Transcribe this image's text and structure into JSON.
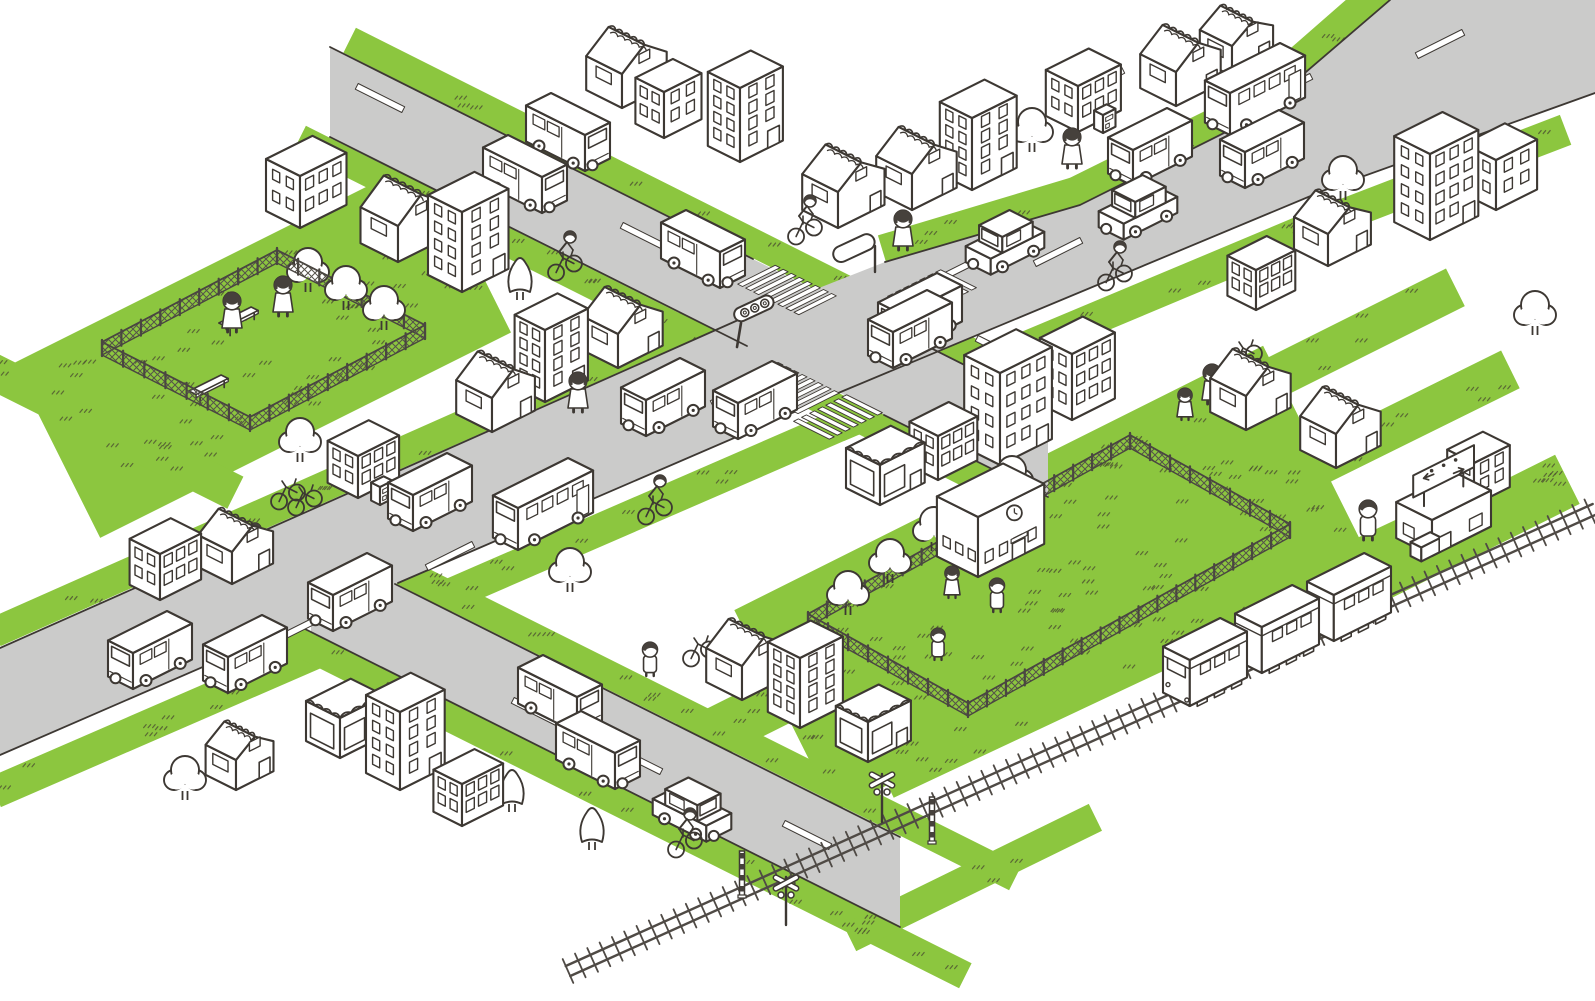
{
  "title": "isometric-town-map-illustration",
  "colors": {
    "outline": "#3d3833",
    "road": "#cbcbca",
    "grass": "#8cc63f",
    "tuft": "#4e5132",
    "white": "#ffffff",
    "mesh": "#55524a",
    "rail": "#4f4a45"
  },
  "roads": {
    "fills": [
      {
        "name": "avenue-ne-sw",
        "pts": [
          [
            0,
            648
          ],
          [
            745,
            317
          ],
          [
            885,
            262
          ],
          [
            1080,
            205
          ],
          [
            1250,
            120
          ],
          [
            1390,
            0
          ],
          [
            1595,
            0
          ],
          [
            1595,
            93
          ],
          [
            1325,
            190
          ],
          [
            843,
            391
          ],
          [
            398,
            583
          ],
          [
            258,
            643
          ],
          [
            0,
            755
          ]
        ]
      },
      {
        "name": "road-nw",
        "pts": [
          [
            330,
            47
          ],
          [
            1048,
            407
          ],
          [
            1048,
            497
          ],
          [
            330,
            137
          ]
        ]
      },
      {
        "name": "road-crossing-branch",
        "pts": [
          [
            311,
            542
          ],
          [
            900,
            836
          ],
          [
            900,
            926
          ],
          [
            311,
            632
          ]
        ]
      }
    ],
    "edges": [
      [
        [
          0,
          648
        ],
        [
          745,
          317
        ]
      ],
      [
        [
          885,
          262
        ],
        [
          1080,
          205
        ],
        [
          1250,
          120
        ],
        [
          1390,
          0
        ]
      ],
      [
        [
          0,
          755
        ],
        [
          258,
          643
        ]
      ],
      [
        [
          398,
          583
        ],
        [
          843,
          391
        ],
        [
          1325,
          190
        ],
        [
          1595,
          93
        ]
      ],
      [
        [
          330,
          47
        ],
        [
          753,
          259
        ]
      ],
      [
        [
          887,
          326
        ],
        [
          1048,
          407
        ]
      ],
      [
        [
          330,
          137
        ],
        [
          747,
          346
        ]
      ],
      [
        [
          884,
          415
        ],
        [
          1048,
          497
        ]
      ],
      [
        [
          395,
          584
        ],
        [
          900,
          837
        ]
      ],
      [
        [
          299,
          626
        ],
        [
          900,
          927
        ]
      ]
    ],
    "dashes_ne": [
      [
        300,
        628
      ],
      [
        450,
        556
      ],
      [
        735,
        392
      ],
      [
        965,
        266
      ],
      [
        1058,
        252
      ],
      [
        1100,
        82
      ],
      [
        1288,
        88
      ],
      [
        1440,
        44
      ]
    ],
    "dashes_se": [
      [
        380,
        98
      ],
      [
        645,
        237
      ],
      [
        1000,
        350
      ],
      [
        536,
        712
      ],
      [
        638,
        760
      ],
      [
        807,
        835
      ]
    ]
  },
  "intersection": {
    "x": 815,
    "y": 335,
    "crosswalks": [
      {
        "c": [
          787,
          290
        ],
        "stripe_axis": "ne",
        "repeat_axis": "se",
        "n": 8,
        "step": 9,
        "len": 42
      },
      {
        "c": [
          932,
          292
        ],
        "stripe_axis": "se",
        "repeat_axis": "ne",
        "n": 7,
        "step": 9,
        "len": 40
      },
      {
        "c": [
          788,
          388
        ],
        "stripe_axis": "ne",
        "repeat_axis": "se",
        "n": 8,
        "step": 9,
        "len": 46
      },
      {
        "c": [
          838,
          417
        ],
        "stripe_axis": "se",
        "repeat_axis": "ne",
        "n": 7,
        "step": 9,
        "len": 40
      }
    ]
  },
  "railway": {
    "x1": 568,
    "y1": 971,
    "x2": 1595,
    "y2": 509,
    "tie_step": 13.5,
    "tie_half": 13,
    "gauge_half": 5.5
  },
  "crossing_signals": [
    {
      "type": "stripe-pole",
      "x": 742,
      "y": 897
    },
    {
      "type": "crossbuck",
      "x": 786,
      "y": 925
    },
    {
      "type": "crossbuck",
      "x": 882,
      "y": 822
    },
    {
      "type": "stripe-pole",
      "x": 932,
      "y": 843
    }
  ],
  "greens": [
    {
      "pts": [
        [
          0,
          790
        ],
        [
          843,
          424
        ],
        [
          1325,
          222
        ],
        [
          1560,
          132
        ]
      ],
      "w": 32
    },
    {
      "pts": [
        [
          0,
          630
        ],
        [
          745,
          300
        ]
      ],
      "w": 30
    },
    {
      "pts": [
        [
          888,
          248
        ],
        [
          1075,
          192
        ],
        [
          1245,
          108
        ],
        [
          1380,
          -10
        ]
      ],
      "w": 30
    },
    {
      "pts": [
        [
          305,
          141
        ],
        [
          1023,
          501
        ]
      ],
      "w": 28
    },
    {
      "pts": [
        [
          355,
          43
        ],
        [
          1073,
          403
        ]
      ],
      "w": 28
    },
    {
      "pts": [
        [
          286,
          636
        ],
        [
          960,
          973
        ]
      ],
      "w": 28
    },
    {
      "pts": [
        [
          336,
          538
        ],
        [
          1010,
          875
        ]
      ],
      "w": 28
    },
    {
      "pts": [
        [
          891,
          778
        ],
        [
          1440,
          520
        ]
      ],
      "w": 38
    },
    {
      "pts": [
        [
          855,
          935
        ],
        [
          1090,
          820
        ]
      ],
      "w": 30
    },
    {
      "pts": [
        [
          62,
          448
        ],
        [
          462,
          248
        ]
      ],
      "w": 195
    },
    {
      "pts": [
        [
          790,
          708
        ],
        [
          1308,
          449
        ]
      ],
      "w": 225
    },
    {
      "pts": [
        [
          1090,
          470
        ],
        [
          1450,
          290
        ]
      ],
      "w": 42
    },
    {
      "pts": [
        [
          1125,
          560
        ],
        [
          1505,
          372
        ]
      ],
      "w": 42
    },
    {
      "pts": [
        [
          1330,
          598
        ],
        [
          1562,
          482
        ]
      ],
      "w": 55
    },
    {
      "pts": [
        [
          640,
          770
        ],
        [
          950,
          615
        ]
      ],
      "w": 50
    },
    {
      "pts": [
        [
          -10,
          370
        ],
        [
          230,
          490
        ]
      ],
      "w": 36
    }
  ],
  "parks": [
    {
      "name": "pocket-park",
      "quad": [
        [
          277,
          263
        ],
        [
          425,
          338
        ],
        [
          250,
          430
        ],
        [
          102,
          355
        ]
      ]
    },
    {
      "name": "schoolyard",
      "quad": [
        [
          1130,
          448
        ],
        [
          1290,
          537
        ],
        [
          968,
          716
        ],
        [
          808,
          627
        ]
      ]
    }
  ],
  "benches": [
    [
      235,
      322
    ],
    [
      205,
      390
    ]
  ],
  "buildings": [
    {
      "t": "office",
      "x": 300,
      "y": 228,
      "w": 52,
      "d": 38,
      "h": 52,
      "f": 2,
      "c": 3
    },
    {
      "t": "house",
      "x": 398,
      "y": 262,
      "w": 52,
      "d": 42,
      "h": 36,
      "rh": 20
    },
    {
      "t": "office",
      "x": 462,
      "y": 292,
      "w": 52,
      "d": 38,
      "h": 80,
      "f": 4,
      "c": 2,
      "door": true
    },
    {
      "t": "house",
      "x": 622,
      "y": 108,
      "w": 50,
      "d": 40,
      "h": 34,
      "rh": 18
    },
    {
      "t": "office",
      "x": 664,
      "y": 138,
      "w": 42,
      "d": 32,
      "h": 46,
      "f": 2,
      "c": 2
    },
    {
      "t": "office",
      "x": 740,
      "y": 162,
      "w": 48,
      "d": 36,
      "h": 74,
      "f": 4,
      "c": 2,
      "door": true
    },
    {
      "t": "house",
      "x": 838,
      "y": 228,
      "w": 52,
      "d": 40,
      "h": 36,
      "rh": 18
    },
    {
      "t": "house",
      "x": 492,
      "y": 432,
      "w": 48,
      "d": 40,
      "h": 34,
      "rh": 18
    },
    {
      "t": "office",
      "x": 545,
      "y": 402,
      "w": 48,
      "d": 34,
      "h": 72,
      "f": 4,
      "c": 2,
      "door": true
    },
    {
      "t": "house",
      "x": 618,
      "y": 368,
      "w": 50,
      "d": 40,
      "h": 34,
      "rh": 18
    },
    {
      "t": "office",
      "x": 358,
      "y": 498,
      "w": 46,
      "d": 34,
      "h": 42,
      "f": 2,
      "c": 3
    },
    {
      "t": "office",
      "x": 160,
      "y": 600,
      "w": 46,
      "d": 34,
      "h": 46,
      "f": 2,
      "c": 3
    },
    {
      "t": "house",
      "x": 232,
      "y": 584,
      "w": 46,
      "d": 38,
      "h": 32,
      "rh": 16
    },
    {
      "t": "shop",
      "x": 340,
      "y": 758,
      "w": 50,
      "d": 38,
      "h": 40
    },
    {
      "t": "office",
      "x": 400,
      "y": 790,
      "w": 50,
      "d": 38,
      "h": 78,
      "f": 4,
      "c": 2,
      "door": true
    },
    {
      "t": "office",
      "x": 462,
      "y": 826,
      "w": 46,
      "d": 32,
      "h": 42,
      "f": 2,
      "c": 3
    },
    {
      "t": "house",
      "x": 236,
      "y": 790,
      "w": 42,
      "d": 34,
      "h": 30,
      "rh": 14
    },
    {
      "t": "house",
      "x": 742,
      "y": 700,
      "w": 50,
      "d": 40,
      "h": 34,
      "rh": 18
    },
    {
      "t": "office",
      "x": 800,
      "y": 728,
      "w": 48,
      "d": 36,
      "h": 70,
      "f": 4,
      "c": 2
    },
    {
      "t": "shop",
      "x": 868,
      "y": 762,
      "w": 48,
      "d": 36,
      "h": 40
    },
    {
      "t": "shop",
      "x": 880,
      "y": 505,
      "w": 50,
      "d": 38,
      "h": 40
    },
    {
      "t": "office",
      "x": 938,
      "y": 480,
      "w": 44,
      "d": 32,
      "h": 44,
      "f": 2,
      "c": 3
    },
    {
      "t": "office",
      "x": 1000,
      "y": 465,
      "w": 58,
      "d": 40,
      "h": 92,
      "f": 4,
      "c": 3,
      "door": true
    },
    {
      "t": "office",
      "x": 1072,
      "y": 420,
      "w": 48,
      "d": 36,
      "h": 66,
      "f": 3,
      "c": 3
    },
    {
      "t": "school",
      "x": 978,
      "y": 577,
      "w": 74,
      "d": 46,
      "h": 60
    },
    {
      "t": "house",
      "x": 912,
      "y": 210,
      "w": 50,
      "d": 40,
      "h": 36,
      "rh": 18
    },
    {
      "t": "office",
      "x": 972,
      "y": 190,
      "w": 50,
      "d": 36,
      "h": 72,
      "f": 4,
      "c": 2,
      "door": true
    },
    {
      "t": "office",
      "x": 1078,
      "y": 132,
      "w": 48,
      "d": 36,
      "h": 46,
      "f": 2,
      "c": 3
    },
    {
      "t": "house",
      "x": 1176,
      "y": 106,
      "w": 50,
      "d": 40,
      "h": 34,
      "rh": 18
    },
    {
      "t": "house",
      "x": 1232,
      "y": 76,
      "w": 46,
      "d": 36,
      "h": 30,
      "rh": 14
    },
    {
      "t": "office",
      "x": 1430,
      "y": 240,
      "w": 54,
      "d": 40,
      "h": 86,
      "f": 4,
      "c": 3,
      "door": true
    },
    {
      "t": "office",
      "x": 1496,
      "y": 210,
      "w": 46,
      "d": 36,
      "h": 50,
      "f": 2,
      "c": 2
    },
    {
      "t": "house",
      "x": 1328,
      "y": 266,
      "w": 48,
      "d": 38,
      "h": 32,
      "rh": 16
    },
    {
      "t": "office",
      "x": 1256,
      "y": 310,
      "w": 44,
      "d": 32,
      "h": 40,
      "f": 2,
      "c": 3
    },
    {
      "t": "house",
      "x": 1246,
      "y": 430,
      "w": 50,
      "d": 40,
      "h": 34,
      "rh": 18
    },
    {
      "t": "house",
      "x": 1336,
      "y": 468,
      "w": 50,
      "d": 40,
      "h": 34,
      "rh": 18
    },
    {
      "t": "office",
      "x": 1474,
      "y": 505,
      "w": 40,
      "d": 30,
      "h": 42,
      "f": 2,
      "c": 2
    },
    {
      "t": "station",
      "x": 1432,
      "y": 556,
      "w": 66,
      "d": 40,
      "h": 36
    }
  ],
  "vehicles": [
    {
      "t": "van",
      "x": 1150,
      "y": 165,
      "o": "sw"
    },
    {
      "t": "van",
      "x": 1262,
      "y": 167,
      "o": "ne"
    },
    {
      "t": "car",
      "x": 1138,
      "y": 220,
      "o": "sw"
    },
    {
      "t": "bus",
      "x": 1255,
      "y": 110,
      "o": "sw"
    },
    {
      "t": "car",
      "x": 1005,
      "y": 255,
      "o": "sw"
    },
    {
      "t": "van",
      "x": 920,
      "y": 330,
      "o": "ne"
    },
    {
      "t": "van",
      "x": 663,
      "y": 415,
      "o": "sw"
    },
    {
      "t": "van",
      "x": 755,
      "y": 418,
      "o": "ne"
    },
    {
      "t": "van",
      "x": 350,
      "y": 610,
      "o": "ne"
    },
    {
      "t": "van",
      "x": 150,
      "y": 668,
      "o": "sw"
    },
    {
      "t": "van",
      "x": 245,
      "y": 672,
      "o": "ne"
    },
    {
      "t": "bus",
      "x": 543,
      "y": 525,
      "o": "sw"
    },
    {
      "t": "van",
      "x": 430,
      "y": 510,
      "o": "sw"
    },
    {
      "t": "van",
      "x": 525,
      "y": 192,
      "o": "se"
    },
    {
      "t": "van",
      "x": 568,
      "y": 150,
      "o": "nw"
    },
    {
      "t": "van",
      "x": 703,
      "y": 267,
      "o": "nw"
    },
    {
      "t": "van",
      "x": 910,
      "y": 347,
      "o": "sw"
    },
    {
      "t": "van",
      "x": 560,
      "y": 712,
      "o": "se"
    },
    {
      "t": "van",
      "x": 598,
      "y": 768,
      "o": "se"
    },
    {
      "t": "car",
      "x": 692,
      "y": 822,
      "o": "se"
    }
  ],
  "train": {
    "cars": [
      [
        1205,
        685
      ],
      [
        1277,
        652
      ],
      [
        1349,
        620
      ]
    ]
  },
  "trees": [
    {
      "t": "p",
      "x": 322,
      "y": 208
    },
    {
      "t": "c",
      "x": 520,
      "y": 300
    },
    {
      "t": "p",
      "x": 758,
      "y": 152
    },
    {
      "t": "p",
      "x": 1032,
      "y": 152
    },
    {
      "t": "p",
      "x": 1343,
      "y": 200
    },
    {
      "t": "p",
      "x": 975,
      "y": 448
    },
    {
      "t": "p",
      "x": 300,
      "y": 462
    },
    {
      "t": "p",
      "x": 570,
      "y": 592
    },
    {
      "t": "p",
      "x": 185,
      "y": 800
    },
    {
      "t": "c",
      "x": 512,
      "y": 812
    },
    {
      "t": "c",
      "x": 592,
      "y": 850
    },
    {
      "t": "p",
      "x": 1535,
      "y": 335
    },
    {
      "t": "p",
      "x": 308,
      "y": 292
    },
    {
      "t": "p",
      "x": 346,
      "y": 310
    },
    {
      "t": "p",
      "x": 384,
      "y": 330
    },
    {
      "t": "p",
      "x": 848,
      "y": 615
    },
    {
      "t": "p",
      "x": 890,
      "y": 583
    },
    {
      "t": "p",
      "x": 934,
      "y": 551
    },
    {
      "t": "p",
      "x": 1012,
      "y": 500
    }
  ],
  "people": [
    {
      "t": "w",
      "x": 232,
      "y": 332,
      "s": 2
    },
    {
      "t": "w",
      "x": 283,
      "y": 316,
      "s": 2
    },
    {
      "t": "w",
      "x": 903,
      "y": 250,
      "s": 2
    },
    {
      "t": "w",
      "x": 1072,
      "y": 168,
      "s": 2
    },
    {
      "t": "w",
      "x": 578,
      "y": 412,
      "s": 2
    },
    {
      "t": "g",
      "x": 1185,
      "y": 420,
      "s": 1.6
    },
    {
      "t": "w",
      "x": 1212,
      "y": 404,
      "s": 2
    },
    {
      "t": "m",
      "x": 1368,
      "y": 540,
      "s": 2
    },
    {
      "t": "b",
      "x": 650,
      "y": 676,
      "s": 1.7
    },
    {
      "t": "g",
      "x": 952,
      "y": 598,
      "s": 1.6
    },
    {
      "t": "b",
      "x": 997,
      "y": 612,
      "s": 1.7
    },
    {
      "t": "b",
      "x": 938,
      "y": 660,
      "s": 1.6
    }
  ],
  "cyclists": [
    [
      565,
      268
    ],
    [
      805,
      232
    ],
    [
      1115,
      278
    ],
    [
      655,
      512
    ],
    [
      250,
      560
    ],
    [
      685,
      845
    ]
  ],
  "bicycles": [
    [
      288,
      497
    ],
    [
      305,
      503
    ],
    [
      700,
      654
    ],
    [
      1245,
      358
    ]
  ],
  "street_furniture": {
    "traffic_light": {
      "x": 737,
      "y": 347
    },
    "signboard": {
      "x": 875,
      "y": 272
    },
    "vending_machines": [
      [
        1103,
        133
      ],
      [
        380,
        505
      ]
    ]
  }
}
